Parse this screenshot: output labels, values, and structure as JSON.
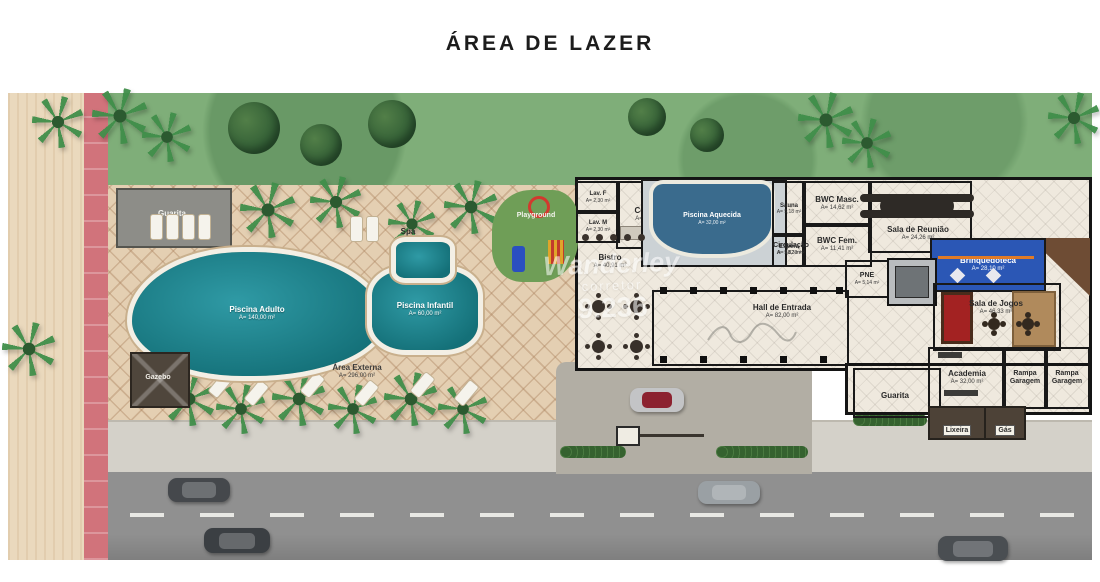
{
  "title": "ÁREA DE LAZER",
  "watermark": {
    "line1": "Wanderley",
    "line2": "corretor",
    "line3": "9.236"
  },
  "outdoor": {
    "guarita_top": {
      "name": "Guarita"
    },
    "spa": {
      "name": "Spa"
    },
    "playground": {
      "name": "Playground"
    },
    "piscina_adulto": {
      "name": "Piscina Adulto",
      "area": "A= 140,00 m²"
    },
    "piscina_infantil": {
      "name": "Piscina Infantil",
      "area": "A= 60,00 m²"
    },
    "gazebo": {
      "name": "Gazebo"
    },
    "area_externa": {
      "name": "Área Externa",
      "area": "A= 296,00 m²"
    }
  },
  "building": {
    "lav_f": {
      "name": "Lav. F",
      "area": "A= 2,30 m²"
    },
    "lav_m": {
      "name": "Lav. M",
      "area": "A= 2,30 m²"
    },
    "cozinha": {
      "name": "Cozinha",
      "area": "A= 9,72 m²"
    },
    "piscina_aquecida": {
      "name": "Piscina Aquecida",
      "area": "A= 32,00 m²"
    },
    "sauna": {
      "name": "Sauna",
      "area": "A= 5,18 m²"
    },
    "bwc_masc": {
      "name": "BWC Masc.",
      "area": "A= 14,62 m²"
    },
    "bwc_fem": {
      "name": "BWC Fem.",
      "area": "A= 11,41 m²"
    },
    "espera": {
      "name": "Espera",
      "area": "A= 5,82 m²"
    },
    "sala_reuniao": {
      "name": "Sala de Reunião",
      "area": "A= 24,26 m²"
    },
    "circulacao": {
      "name": "Circulação",
      "area": "A= 48,30 m²"
    },
    "bistro": {
      "name": "Bistro",
      "area": "A= 40,91 m²"
    },
    "pne": {
      "name": "PNE",
      "area": "A= 5,14 m²"
    },
    "hall_entrada": {
      "name": "Hall de Entrada",
      "area": "A= 82,00 m²"
    },
    "brinquedoteca": {
      "name": "Brinquedoteca",
      "area": "A= 28,10 m²"
    },
    "sala_jogos": {
      "name": "Sala de Jogos",
      "area": "A= 46,33 m²"
    },
    "academia": {
      "name": "Academia",
      "area": "A= 32,00 m²"
    },
    "rampa_garagem_1": {
      "name": "Rampa Garagem"
    },
    "rampa_garagem_2": {
      "name": "Rampa Garagem"
    },
    "guarita_bottom": {
      "name": "Guarita"
    },
    "lixeira": {
      "name": "Lixeira"
    },
    "gas": {
      "name": "Gás"
    }
  }
}
